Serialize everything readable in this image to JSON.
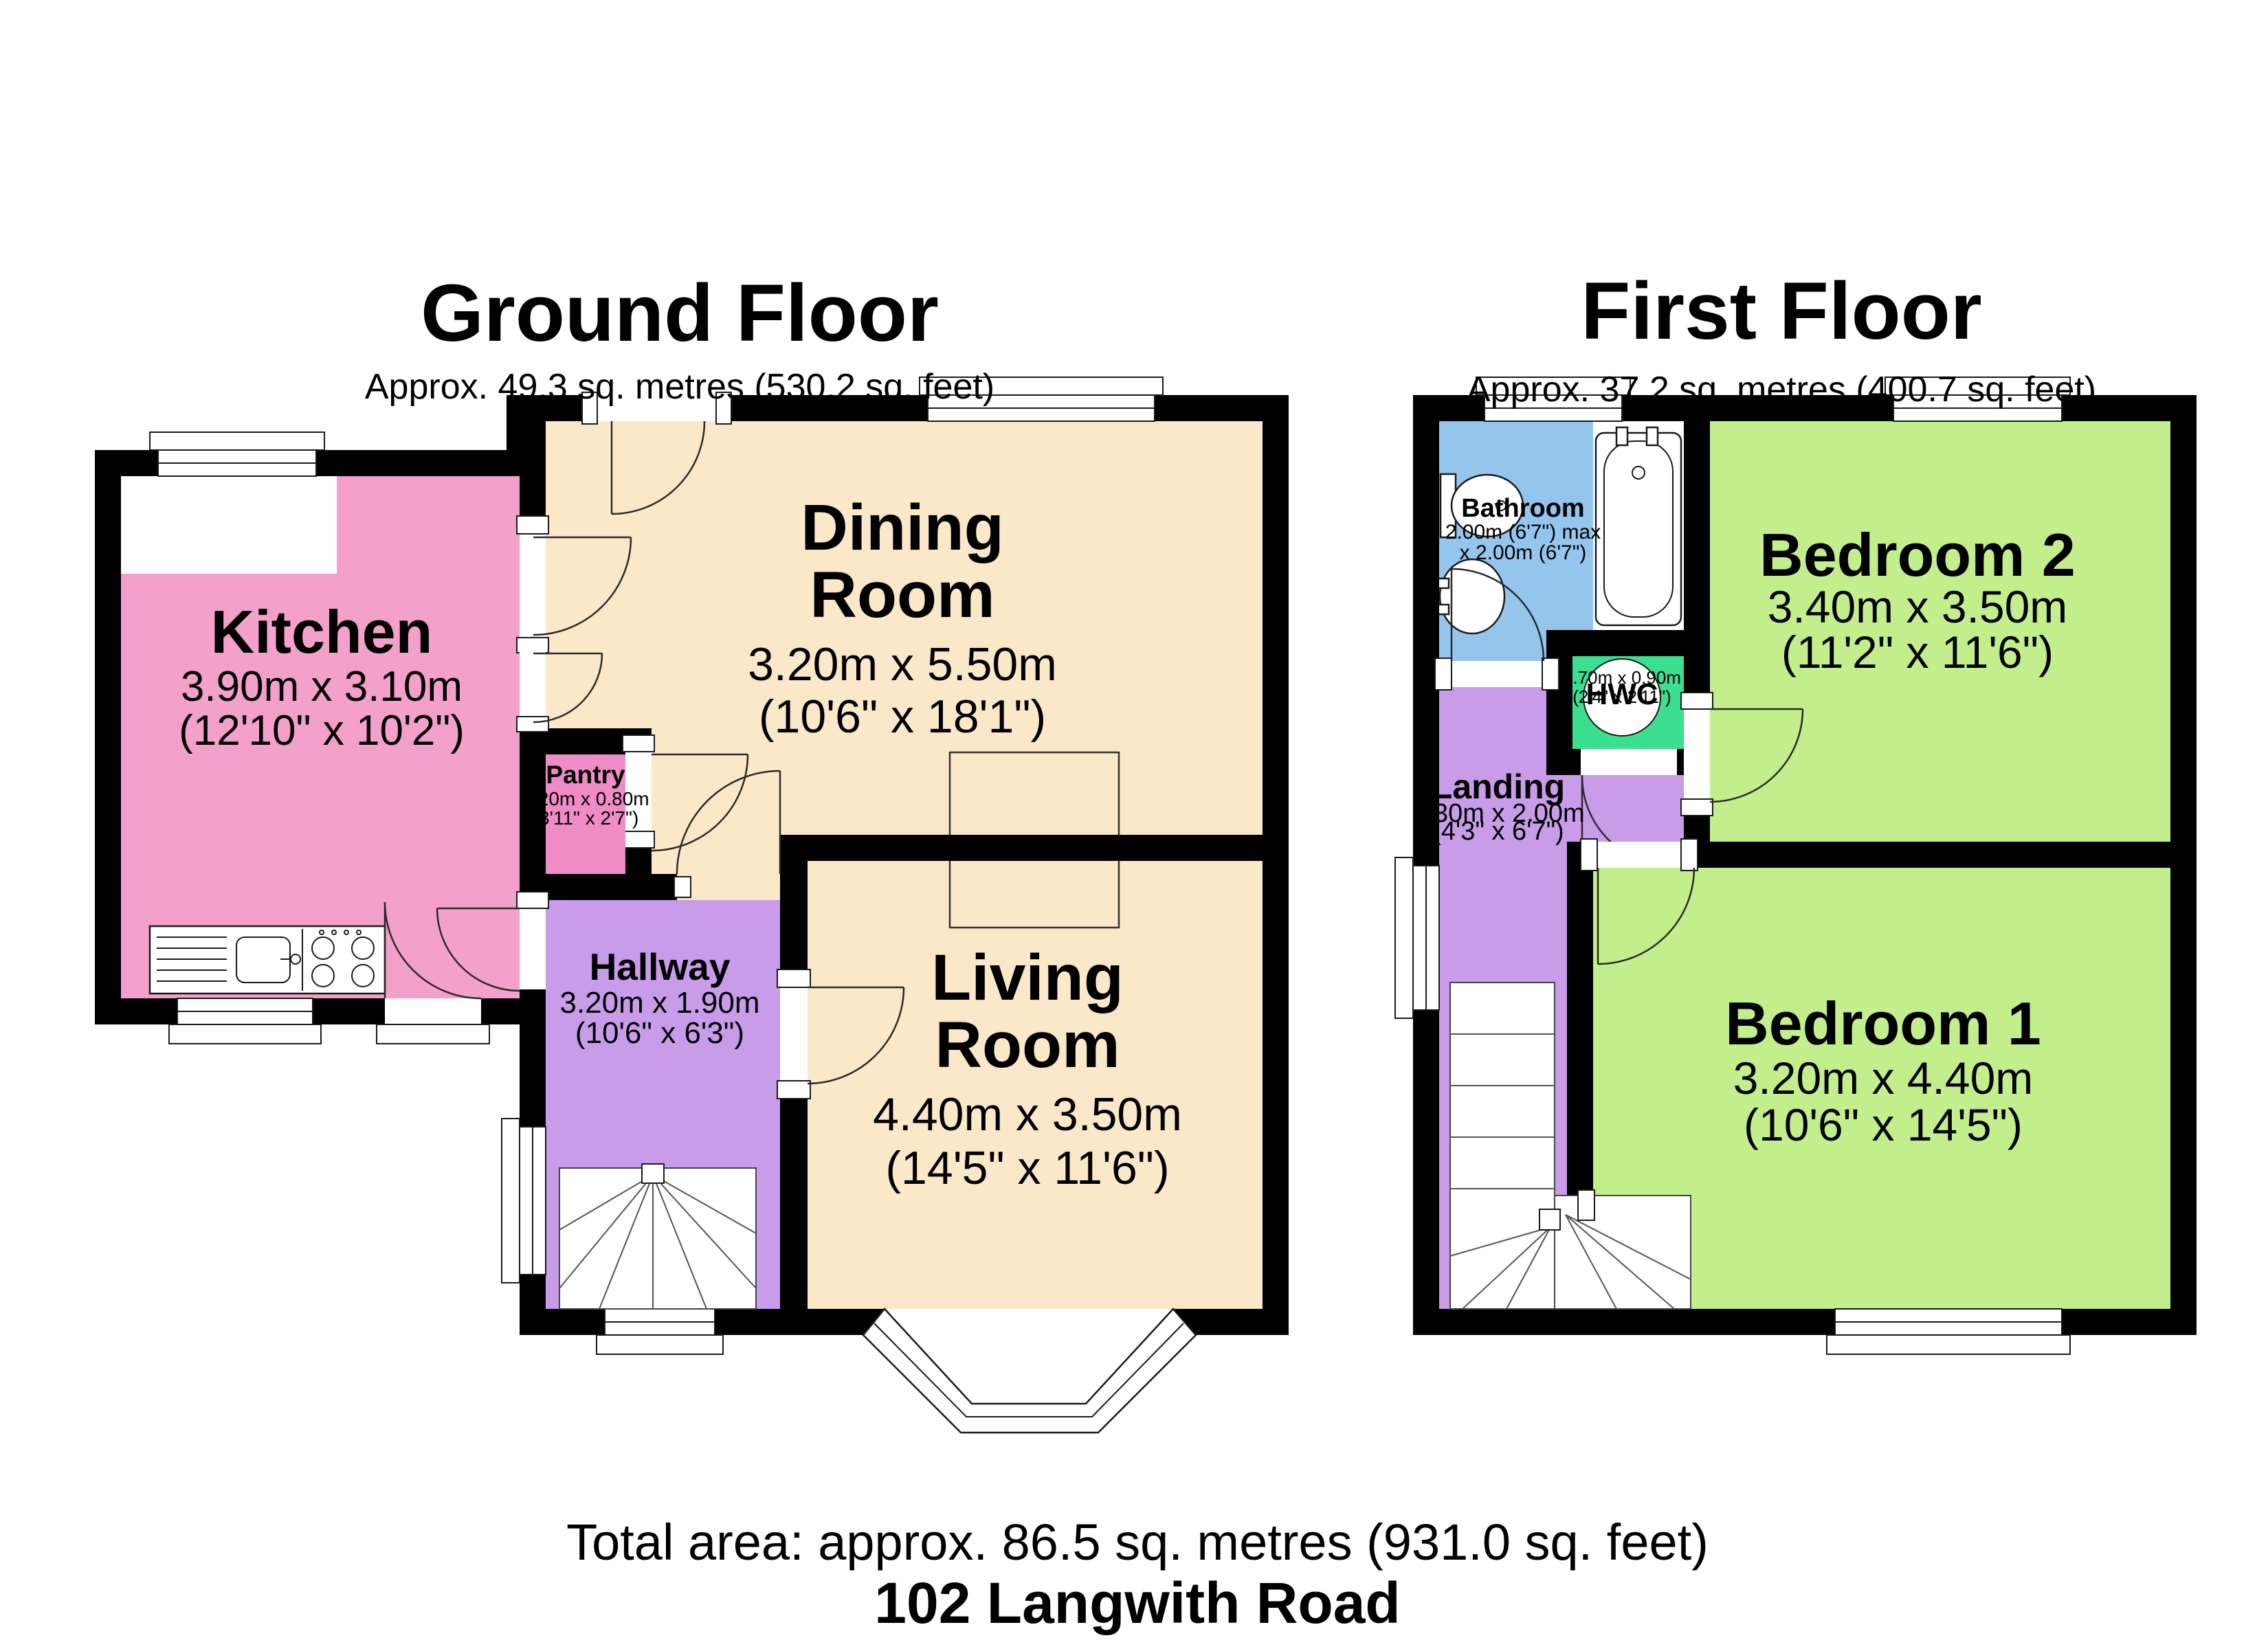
{
  "ground_floor": {
    "title": "Ground Floor",
    "subtitle": "Approx. 49.3 sq. metres (530.2 sq. feet)",
    "rooms": {
      "kitchen": {
        "name": "Kitchen",
        "dims_m": "3.90m x 3.10m",
        "dims_ft": "(12'10\" x 10'2\")"
      },
      "pantry": {
        "name": "Pantry",
        "dims_m": "1.20m x 0.80m",
        "dims_ft": "(3'11\" x 2'7\")"
      },
      "dining": {
        "name_line1": "Dining",
        "name_line2": "Room",
        "dims_m": "3.20m x 5.50m",
        "dims_ft": "(10'6\" x 18'1\")"
      },
      "hallway": {
        "name": "Hallway",
        "dims_m": "3.20m x 1.90m",
        "dims_ft": "(10'6\" x 6'3\")"
      },
      "living": {
        "name_line1": "Living",
        "name_line2": "Room",
        "dims_m": "4.40m x 3.50m",
        "dims_ft": "(14'5\" x 11'6\")"
      }
    }
  },
  "first_floor": {
    "title": "First Floor",
    "subtitle": "Approx. 37.2 sq. metres (400.7 sq. feet)",
    "rooms": {
      "bathroom": {
        "name": "Bathroom",
        "dims_line1": "2.00m (6'7\") max",
        "dims_line2": "x 2.00m (6'7\")"
      },
      "bedroom2": {
        "name": "Bedroom 2",
        "dims_m": "3.40m x 3.50m",
        "dims_ft": "(11'2\" x 11'6\")"
      },
      "hwc": {
        "name": "HWC",
        "dims_m": "0.70m x 0.90m",
        "dims_ft": "(2'4\" x 2'11\")"
      },
      "landing": {
        "name": "Landing",
        "dims_m": "1.30m x 2.00m",
        "dims_ft": "(4'3\" x 6'7\")"
      },
      "bedroom1": {
        "name": "Bedroom 1",
        "dims_m": "3.20m x 4.40m",
        "dims_ft": "(10'6\" x 14'5\")"
      }
    }
  },
  "footer": {
    "total_area": "Total area: approx. 86.5 sq. metres (931.0 sq. feet)",
    "address": "102 Langwith Road"
  },
  "colors": {
    "wall": "#000000",
    "dining_living_cream": "#FAE8C9",
    "kitchen_pink": "#F3A0CA",
    "pantry_pink": "#EF8CC5",
    "hallway_landing_purple": "#C89CE9",
    "bathroom_blue": "#94C5ED",
    "bedroom_green": "#C2EF8C",
    "hwc_green": "#3CDE90"
  }
}
